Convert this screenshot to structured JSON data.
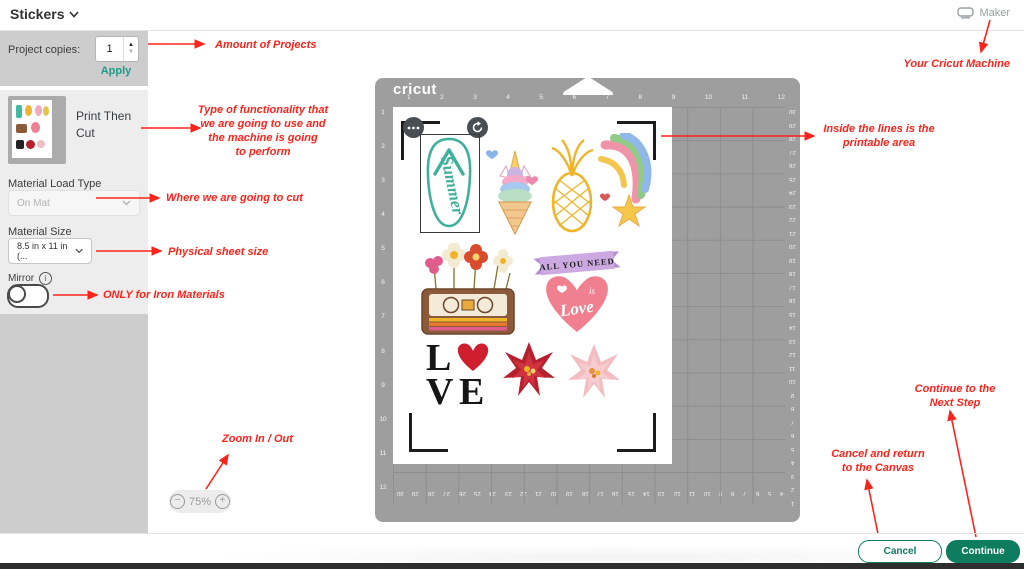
{
  "header": {
    "title": "Stickers",
    "machine_label": "Maker"
  },
  "sidebar": {
    "project_copies_label": "Project copies:",
    "copies_value": "1",
    "apply_label": "Apply",
    "mode_label_line1": "Print Then",
    "mode_label_line2": "Cut",
    "material_load_label": "Material Load Type",
    "material_load_value": "On Mat",
    "material_size_label": "Material Size",
    "material_size_value": "8.5 in x 11 in (...",
    "mirror_label": "Mirror",
    "info_glyph": "i"
  },
  "zoom": {
    "minus": "−",
    "level": "75%",
    "plus": "+"
  },
  "mat": {
    "brand": "cricut",
    "top_ruler": [
      "1",
      "2",
      "3",
      "4",
      "5",
      "6",
      "7",
      "8",
      "9",
      "10",
      "11",
      "12"
    ],
    "left_ruler": [
      "1",
      "2",
      "3",
      "4",
      "5",
      "6",
      "7",
      "8",
      "9",
      "10",
      "11",
      "12"
    ],
    "right_ruler": [
      "30",
      "29",
      "28",
      "27",
      "26",
      "25",
      "24",
      "23",
      "22",
      "21",
      "20",
      "19",
      "18",
      "17",
      "16",
      "15",
      "14",
      "13",
      "12",
      "11",
      "10",
      "9",
      "8",
      "7",
      "6",
      "5",
      "4",
      "3",
      "2",
      "1"
    ],
    "bottom_ruler": [
      "30",
      "29",
      "28",
      "27",
      "26",
      "25",
      "24",
      "23",
      "22",
      "21",
      "20",
      "19",
      "18",
      "17",
      "16",
      "15",
      "14",
      "13",
      "12",
      "11",
      "10",
      "9",
      "8",
      "7",
      "6",
      "5",
      "4"
    ]
  },
  "stickers": {
    "list": [
      "summer-flip-flop",
      "unicorn-ice-cream",
      "pineapple",
      "rainbow-shooting-star",
      "flower-cassette",
      "all-you-need-love-heart",
      "love-letter-block",
      "red-poinsettia",
      "pink-poinsettia"
    ],
    "flipflop_text": "Summer",
    "banner_text": "ALL YOU NEED",
    "heart_is": "is",
    "heart_love": "Love",
    "love_l": "L",
    "love_v": "V",
    "love_e": "E"
  },
  "annotations": {
    "amount": {
      "lines": [
        "Amount of Projects"
      ]
    },
    "machine": {
      "lines": [
        "Your Cricut Machine"
      ]
    },
    "function": {
      "lines": [
        "Type of functionality that",
        "we are going to use and",
        "the machine is going",
        "to perform"
      ]
    },
    "printable": {
      "lines": [
        "Inside the lines is the",
        "printable area"
      ]
    },
    "where": {
      "lines": [
        "Where we are going to cut"
      ]
    },
    "size": {
      "lines": [
        "Physical sheet size"
      ]
    },
    "mirror": {
      "lines": [
        "ONLY for Iron Materials"
      ]
    },
    "zoom": {
      "lines": [
        "Zoom In / Out"
      ]
    },
    "continue": {
      "lines": [
        "Continue to the",
        "Next Step"
      ]
    },
    "cancel": {
      "lines": [
        "Cancel and return",
        "to the Canvas"
      ]
    }
  },
  "footer": {
    "cancel_label": "Cancel",
    "continue_label": "Continue"
  },
  "colors": {
    "accent_green": "#0d7c5f",
    "apply_green": "#1d9b89",
    "annotation_red": "#fb241a",
    "mat_gray": "#9e9e9e"
  }
}
